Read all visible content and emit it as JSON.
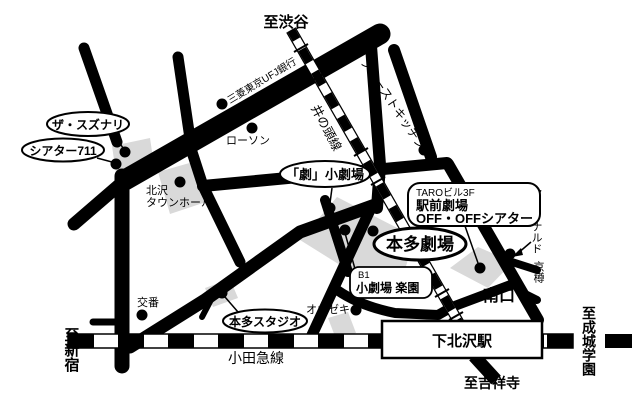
{
  "map": {
    "title_hint": "Shimokitazawa theater access map",
    "colors": {
      "road": "#000000",
      "building": "#d9d9d9",
      "background": "#ffffff",
      "label_fill": "#ffffff"
    },
    "labels": {
      "to_shibuya": "至渋谷",
      "chazawa_dori": "茶沢通り",
      "bank": "三菱東京UFJ銀行",
      "lawson": "ローソン",
      "inokashira_line": "井の頭線",
      "first_kitchen": "ファーストキッチン",
      "suzunari": "ザ・スズナリ",
      "theater711": "シアター711",
      "townhall_line1": "北沢",
      "townhall_line2": "タウンホール",
      "geki_theater": "「劇」小劇場",
      "taro_line1": "TAROビル3F",
      "taro_line2": "駅前劇場",
      "taro_line3": "OFF・OFFシアター",
      "mcdonalds": "マクドナルド",
      "kyotaru": "京樽",
      "honda_theater": "本多劇場",
      "b1": "B1",
      "rakuen": "小劇場 楽園",
      "ozeki": "オオゼキ",
      "minamiguchi": "南口",
      "koban": "交番",
      "honda_studio": "本多スタジオ",
      "to_shinjuku": "至新宿",
      "odakyu_line": "小田急線",
      "station": "下北沢駅",
      "to_kichijoji": "至吉祥寺",
      "to_seijogakuen": "至成城学園"
    }
  }
}
